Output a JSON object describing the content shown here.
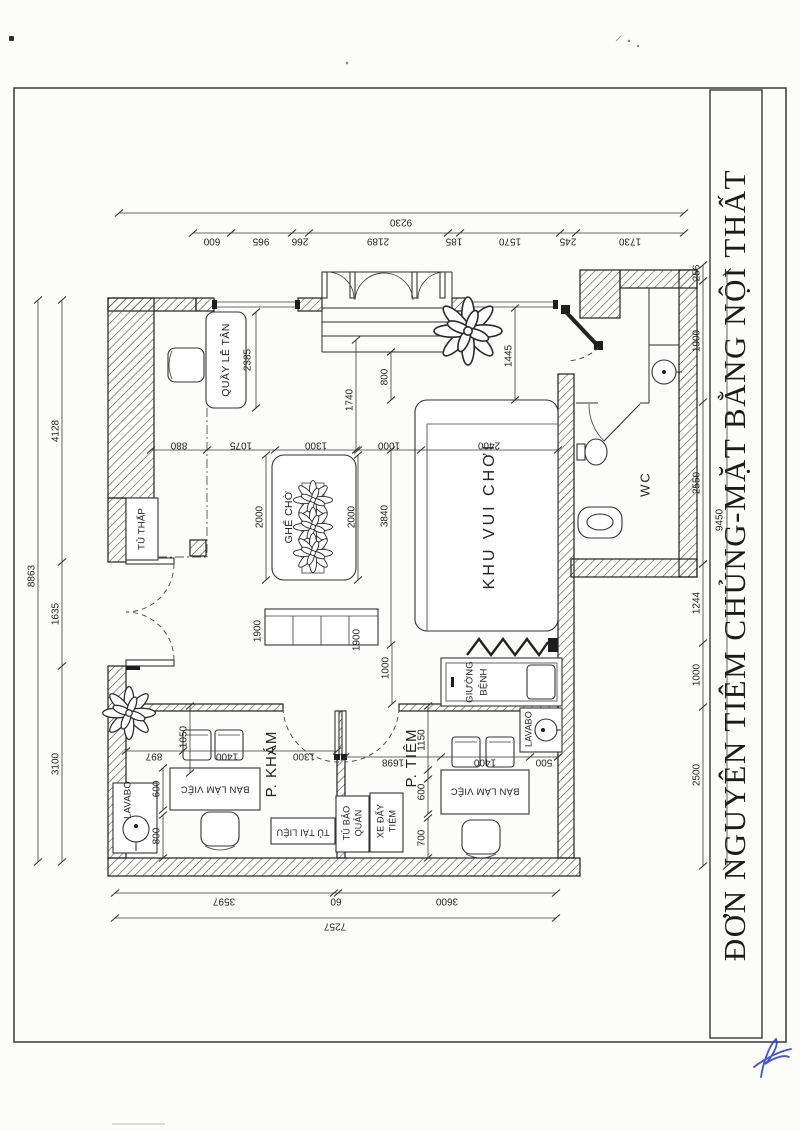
{
  "document": {
    "title": "ĐƠN NGUYÊN TIÊM CHỦNG-MẶT BẰNG NỘI THẤT",
    "ink": "#232323",
    "paper": "#fcfcfa",
    "signature_color": "#2e41c6"
  },
  "labels": {
    "reception": "QUẦY LỄ TÂN",
    "low_cabinet": "TỦ THẤP",
    "waiting_seats": "GHẾ CHỜ",
    "play_area": "KHU VUI CHƠI",
    "wc": "WC",
    "exam_room": "P. KHÁM",
    "injection_room": "P. TIÊM",
    "lavabo_exam": "LAVABO",
    "lavabo_injection": "LAVABO",
    "work_desk_exam": "BÀN LÀM VIỆC",
    "work_desk_injection": "BÀN LÀM VIỆC",
    "document_cabinet": "TỦ TÀI LIỆU",
    "storage_cabinet_line1": "TỦ BẢO",
    "storage_cabinet_line2": "QUẢN",
    "injection_cart_line1": "XE ĐẨY",
    "injection_cart_line2": "TIÊM",
    "patient_bed_line1": "GIƯỜNG",
    "patient_bed_line2": "BỆNH"
  },
  "dimensions": {
    "top_total": "9230",
    "top_chain": [
      "600",
      "965",
      "266",
      "2189",
      "185",
      "1570",
      "245",
      "1730"
    ],
    "bottom_chain": [
      "3597",
      "60",
      "3600"
    ],
    "bottom_total": "7257",
    "left_chain": [
      "4128",
      "1635",
      "3100"
    ],
    "left_total": "8863",
    "right_chain": [
      "256",
      "1900",
      "2550",
      "1244",
      "1000",
      "2500"
    ],
    "right_total": "9450",
    "mid_chain": [
      "880",
      "1075",
      "1300",
      "1000",
      "2400"
    ],
    "reception_depth": "2385",
    "hall_1740": "1740",
    "hall_800": "800",
    "hall_1445": "1445",
    "waiting_2000_left": "2000",
    "waiting_2000_right": "2000",
    "hall_3840": "3840",
    "hall_1000": "1000",
    "shelf_1900_left": "1900",
    "shelf_1900_right": "1900",
    "exam_1050": "1050",
    "exam_chain": [
      "897",
      "1400",
      "1300"
    ],
    "exam_600": "600",
    "exam_800": "800",
    "injection_1150": "1150",
    "injection_chain": [
      "1698",
      "1400",
      "500"
    ],
    "injection_600": "600",
    "injection_700": "700"
  }
}
